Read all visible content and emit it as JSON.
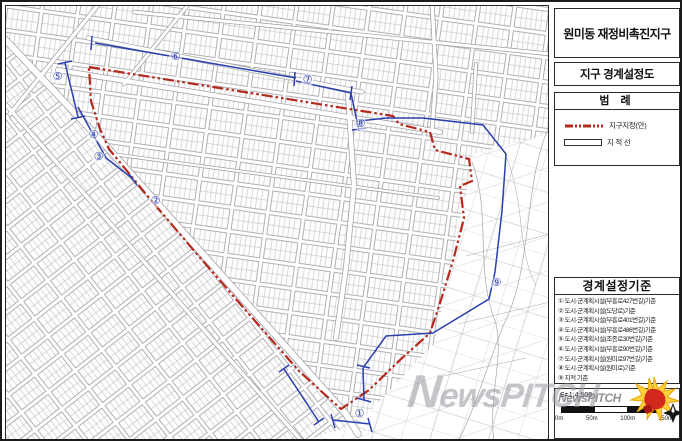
{
  "title_block": {
    "title": "원미동 재정비촉진지구",
    "subtitle": "지구 경계설정도"
  },
  "legend": {
    "header": "범 례",
    "items": [
      {
        "label": "지구지정(안)",
        "swatch": "red-dash-dot-line",
        "color": "#b5281c"
      },
      {
        "label": "지 적 선",
        "swatch": "black-outline-line",
        "color": "#333333"
      }
    ]
  },
  "criteria": {
    "header": "경계설정기준",
    "items": [
      "① 도시·군계획시설(부흥로427번길)기준",
      "② 도시·군계획시설(도당로)기준",
      "③ 도시·군계획시설(부흥로401번길)기준",
      "④ 도시·군계획시설(부흥로486번길)기준",
      "⑤ 도시·군계획시설(조종로30번길)기준",
      "⑥ 도시·군계획시설(부흥로90번길)기준",
      "⑦ 도시·군계획시설(원미로97번길)기준",
      "⑧ 도시·군계획시설(원미로)기준",
      "⑨ 지적 기준"
    ]
  },
  "scale": {
    "label": "S=1:4,500",
    "ticks": [
      "0m",
      "50m",
      "100m",
      "150m"
    ]
  },
  "map": {
    "boundary_label": "지구지정(안)",
    "markers": [
      {
        "label": "①",
        "x": 354,
        "y": 409
      },
      {
        "label": "②",
        "x": 150,
        "y": 196
      },
      {
        "label": "③",
        "x": 93,
        "y": 152
      },
      {
        "label": "④",
        "x": 88,
        "y": 130
      },
      {
        "label": "⑤",
        "x": 52,
        "y": 72
      },
      {
        "label": "⑥",
        "x": 170,
        "y": 52
      },
      {
        "label": "⑦",
        "x": 302,
        "y": 75
      },
      {
        "label": "⑧",
        "x": 355,
        "y": 119
      },
      {
        "label": "⑨",
        "x": 491,
        "y": 278
      }
    ]
  },
  "watermark": {
    "text": "NewsPITCH"
  },
  "colors": {
    "boundary": "#b5281c",
    "survey_line": "#2c3fae",
    "cadastral": "#9a9aa2"
  }
}
